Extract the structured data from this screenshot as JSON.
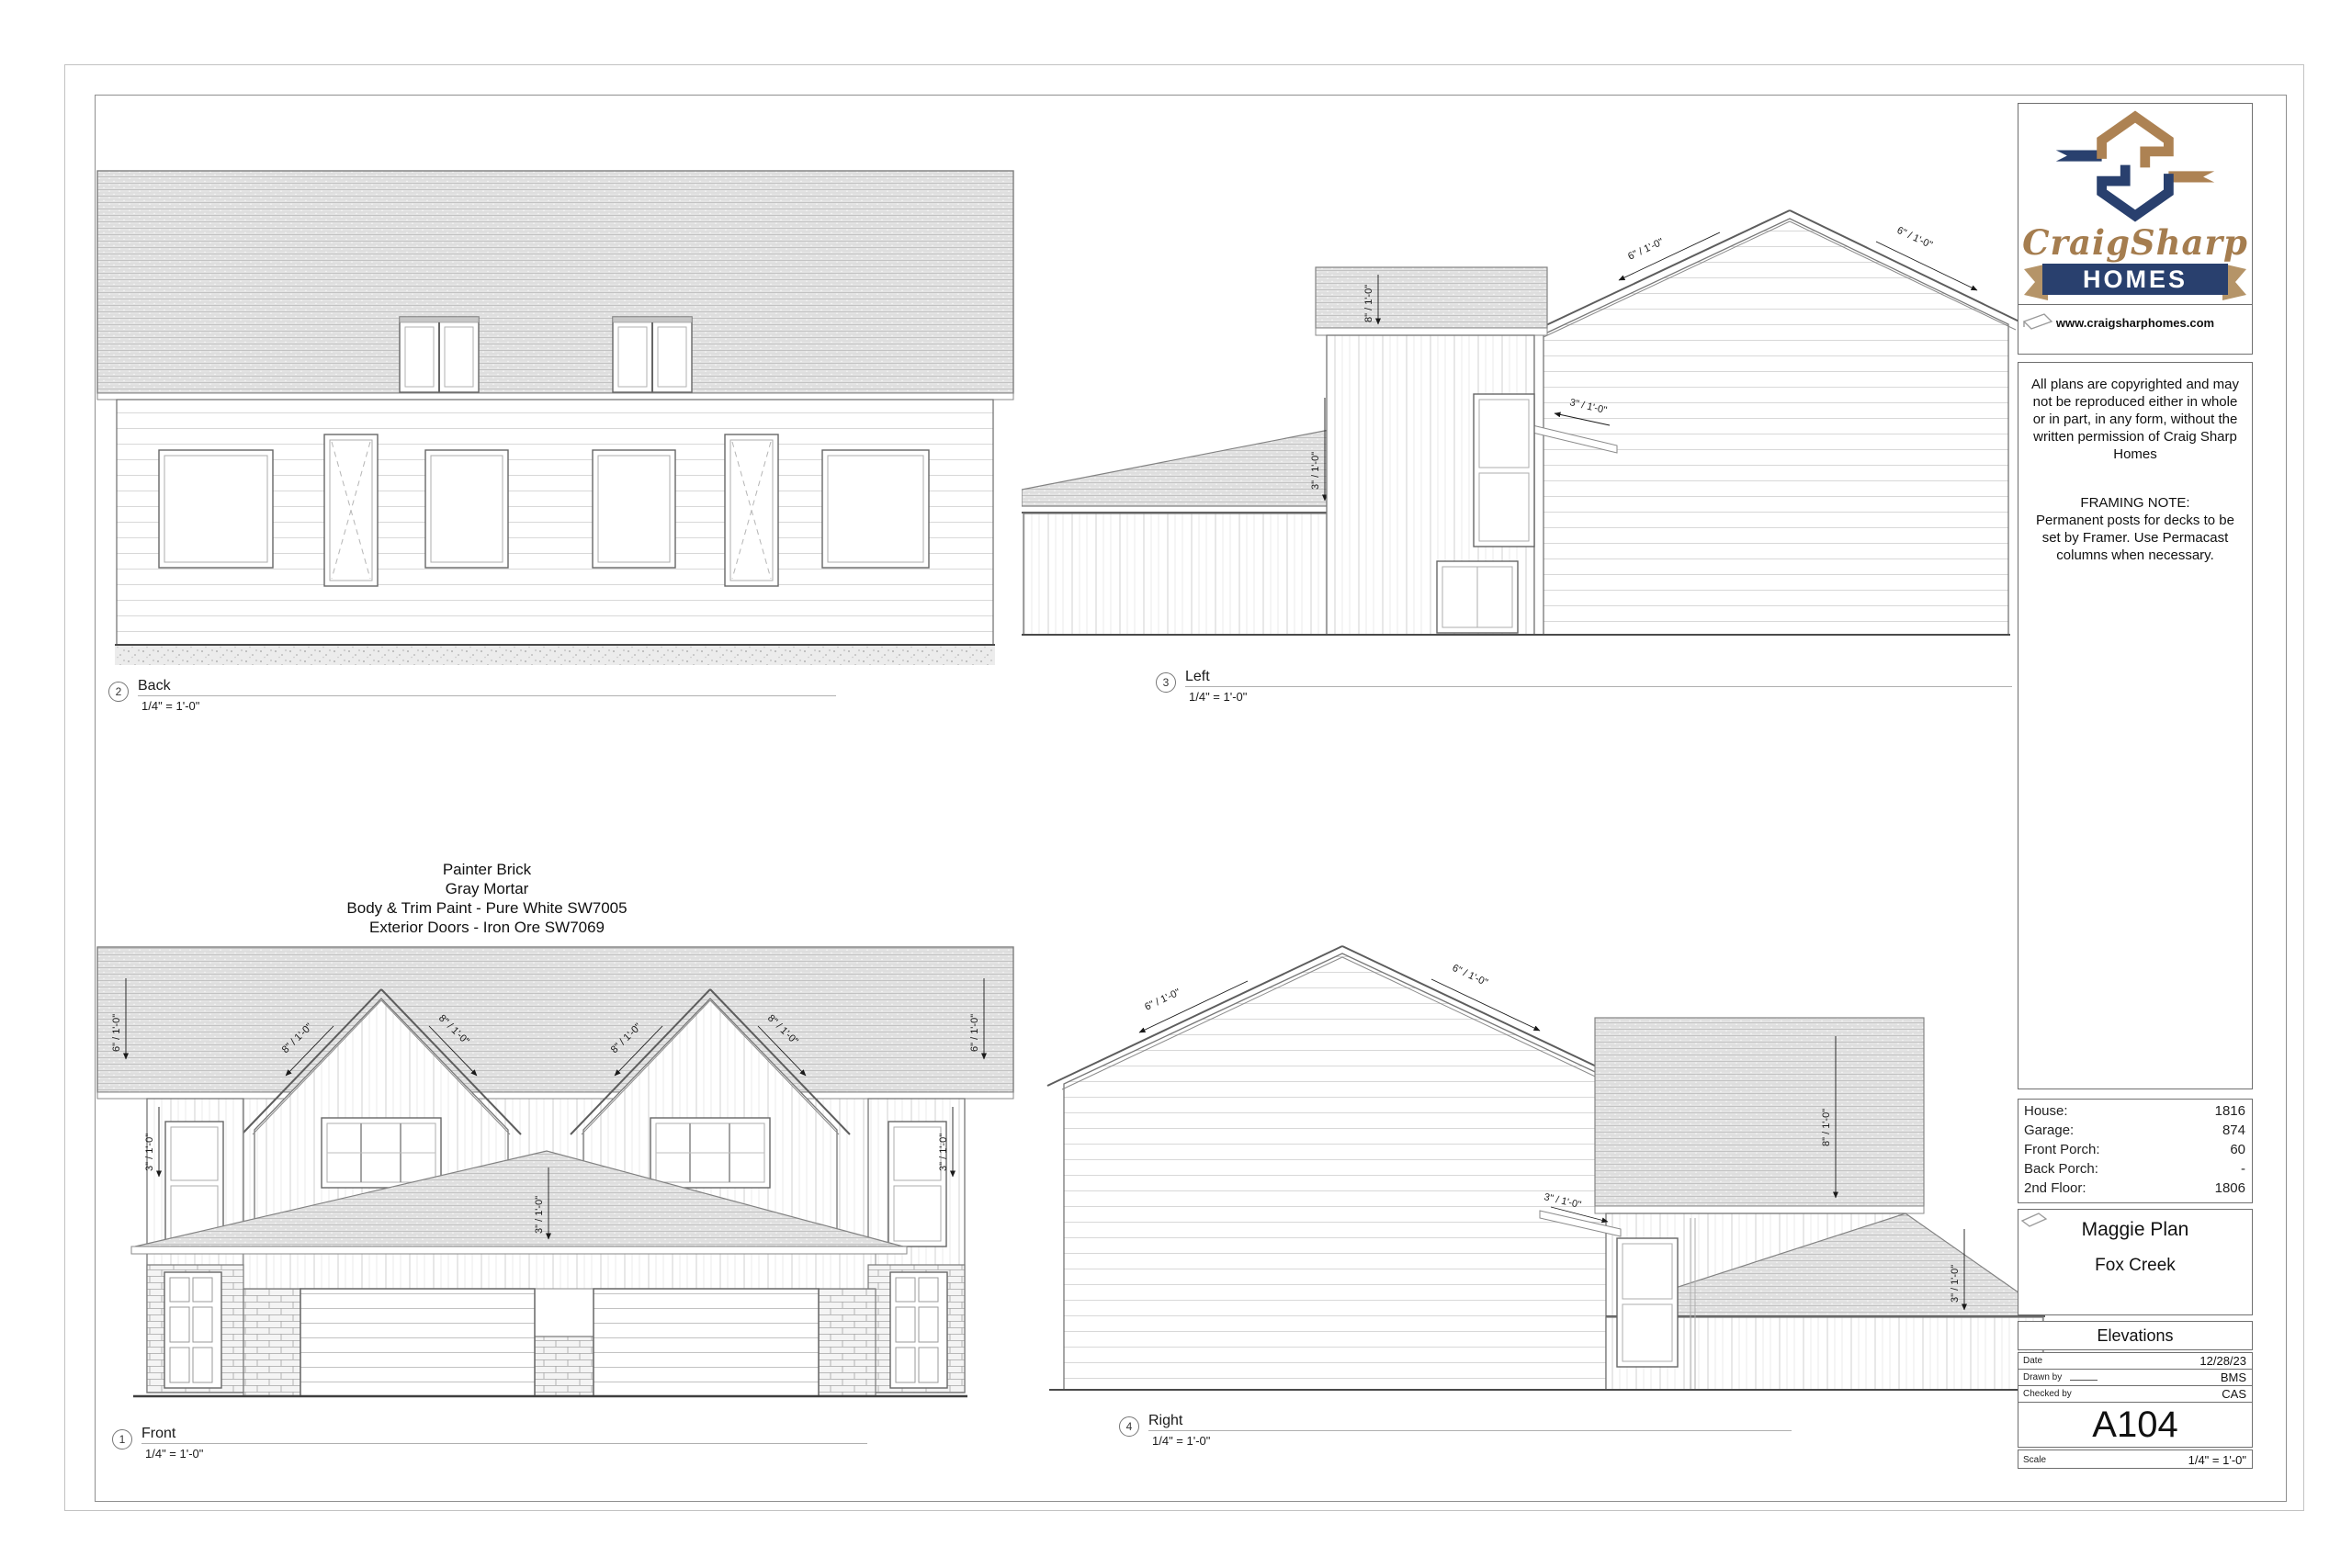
{
  "logo": {
    "script": "CraigSharp",
    "homes": "HOMES",
    "website": "www.craigsharphomes.com",
    "navy": "#29406e",
    "bronze": "#ad8253"
  },
  "notes": {
    "copyright": "All plans are copyrighted and may not be reproduced either in whole or in part, in any form, without the written permission of Craig Sharp Homes",
    "framing_title": "FRAMING NOTE:",
    "framing_body": "Permanent posts for decks to be set by Framer. Use Permacast columns when necessary."
  },
  "stats": {
    "rows": [
      {
        "label": "House:",
        "value": "1816"
      },
      {
        "label": "Garage:",
        "value": "874"
      },
      {
        "label": "Front Porch:",
        "value": "60"
      },
      {
        "label": "Back Porch:",
        "value": "-"
      },
      {
        "label": "2nd Floor:",
        "value": "1806"
      }
    ]
  },
  "plan": {
    "name": "Maggie Plan",
    "subdivision": "Fox Creek",
    "sheet_title": "Elevations"
  },
  "meta": {
    "date_label": "Date",
    "date": "12/28/23",
    "drawn_label": "Drawn by",
    "drawn": "BMS",
    "checked_label": "Checked by",
    "checked": "CAS",
    "sheet_number": "A104",
    "scale_label": "Scale",
    "scale": "1/4\" = 1'-0\""
  },
  "finish_notes": [
    "Painter Brick",
    "Gray Mortar",
    "Body & Trim Paint - Pure White SW7005",
    "Exterior Doors - Iron Ore SW7069"
  ],
  "labels": {
    "front": {
      "num": "1",
      "name": "Front",
      "scale": "1/4\" = 1'-0\""
    },
    "back": {
      "num": "2",
      "name": "Back",
      "scale": "1/4\" = 1'-0\""
    },
    "left": {
      "num": "3",
      "name": "Left",
      "scale": "1/4\" = 1'-0\""
    },
    "right": {
      "num": "4",
      "name": "Right",
      "scale": "1/4\" = 1'-0\""
    }
  },
  "pitches": {
    "p3": "3\" / 1'-0\"",
    "p6": "6\" / 1'-0\"",
    "p8": "8\" / 1'-0\""
  }
}
